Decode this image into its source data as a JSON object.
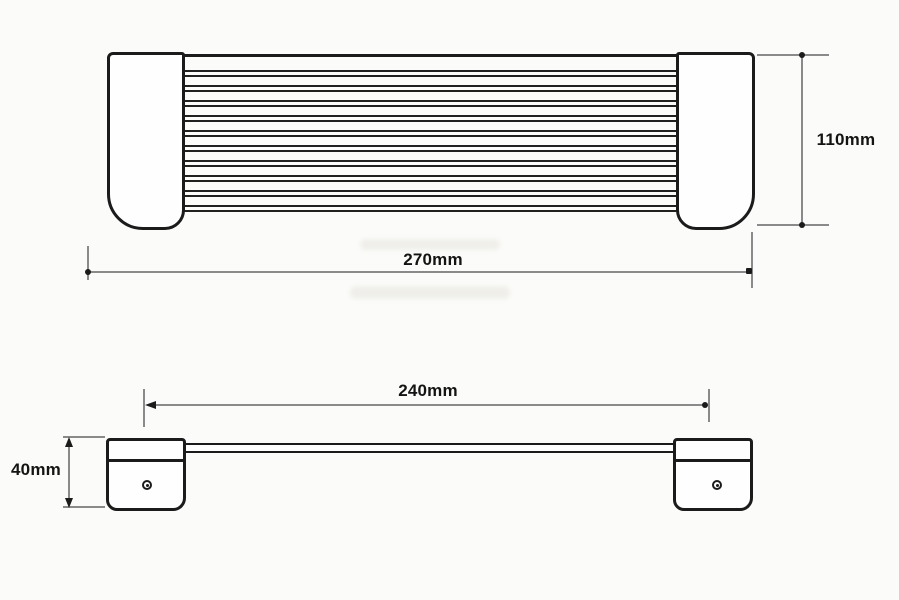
{
  "labels": {
    "top_width": "270mm",
    "top_height": "110mm",
    "front_width": "240mm",
    "front_height": "40mm"
  },
  "dimensions": [
    {
      "view": "top-view",
      "measure": "overall-width",
      "label": "270mm"
    },
    {
      "view": "top-view",
      "measure": "overall-depth",
      "label": "110mm"
    },
    {
      "view": "front-view",
      "measure": "bar-span",
      "label": "240mm"
    },
    {
      "view": "front-view",
      "measure": "bracket-height",
      "label": "40mm"
    }
  ],
  "structure": {
    "slat_count": 10,
    "end_caps": 2,
    "brackets": 2,
    "screw_holes_per_bracket": 1
  },
  "colors": {
    "background": "#fbfbf9",
    "outline": "#1b1b1b",
    "dim_line": "#8a8a8a",
    "text": "#141414"
  }
}
